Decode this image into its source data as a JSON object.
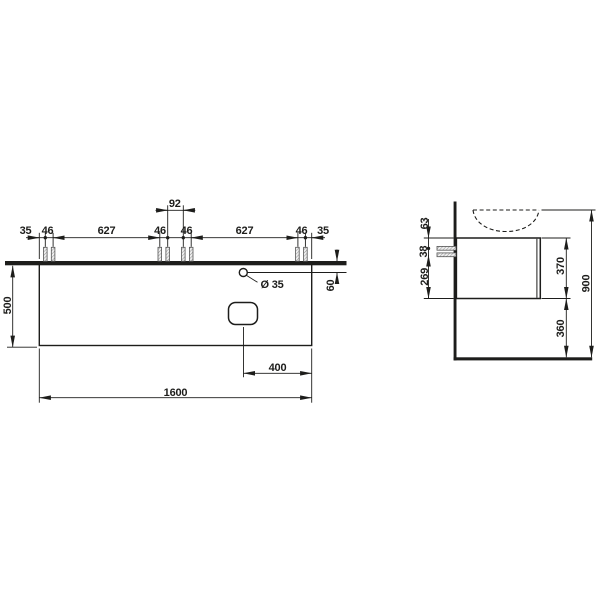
{
  "colors": {
    "line": "#1d1d1b",
    "background": "#ffffff"
  },
  "front": {
    "margin_left": "35",
    "pair_gap_1": "46",
    "span_1": "627",
    "pair_gap_2": "46",
    "center_gap": "92",
    "pair_gap_3": "46",
    "span_2": "627",
    "pair_gap_4": "46",
    "margin_right": "35",
    "height": "500",
    "hole_diameter": "Ø 35",
    "hole_from_top": "60",
    "cutout_from_right": "400",
    "width": "1600"
  },
  "side": {
    "top_to_screw": "63",
    "screw_spacing": "38",
    "screw_to_bottom": "269",
    "cabinet_height": "370",
    "floor_clearance": "360",
    "total_height": "900"
  }
}
